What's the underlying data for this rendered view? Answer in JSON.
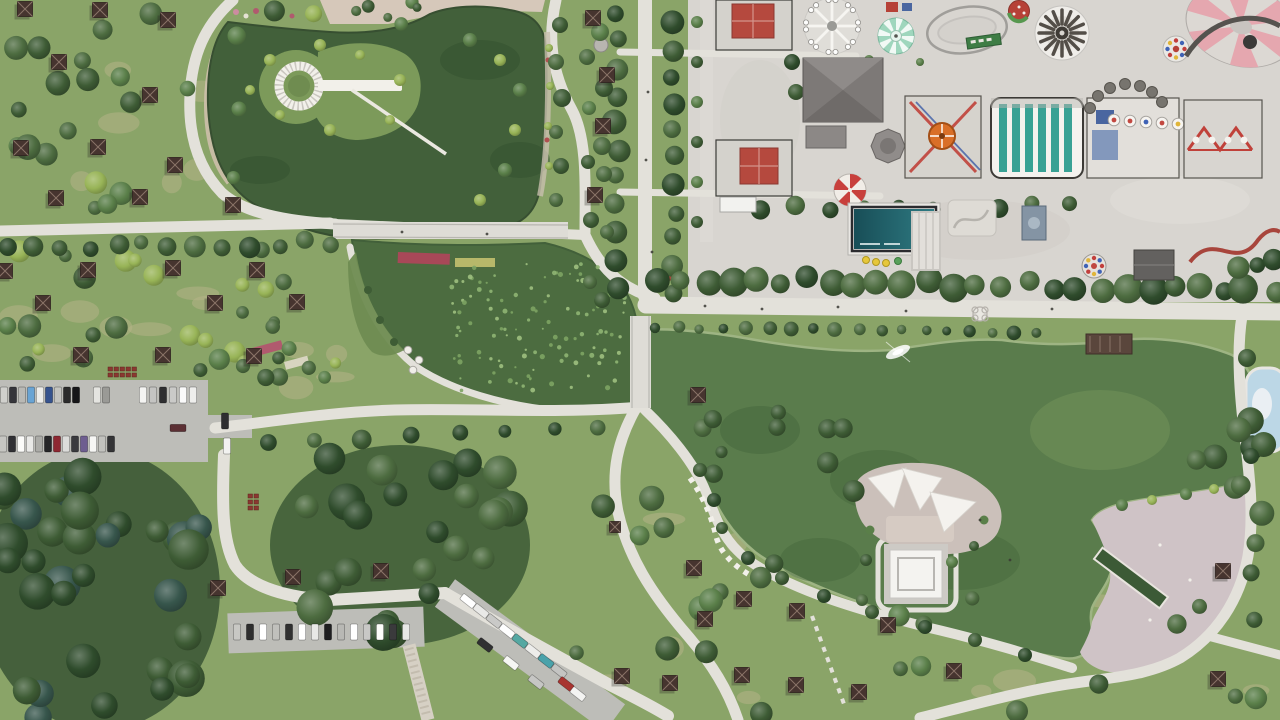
{
  "meta": {
    "description": "Aerial drone photograph of a large urban park: two green ponds connected by channels, winding white paths, picnic gazebo fields, parking lots with cars, dense woods, a pink lakeside plaza with water channel, and an amusement park with rides in the top-right corner",
    "width": 1280,
    "height": 720
  },
  "colors": {
    "grassBase": "#8aa468",
    "grassDry": "#b7b38a",
    "woodsShadow": "#2e4a2e",
    "treePalette": [
      "#4d6c40",
      "#3e5c35",
      "#5a7f49",
      "#2f4c2c",
      "#37564c",
      "#98b457"
    ],
    "lilyPalette": [
      "#8fb573",
      "#9fc07f",
      "#7da463"
    ],
    "path": "#e3e1da",
    "pathDim": "#d7d5ce",
    "asphalt": "#bdbdb8",
    "concrete": "#d8d5d0",
    "pondUpper": "#42603a",
    "pondLily": "#4c6c40",
    "pondMain": "#5a7c4c",
    "poolBlue": "#bcd7e6",
    "plaza": "#cfc3c6",
    "bridge": "#dedcd6",
    "island": "#7c9a5a",
    "islandMain": "#cbc0ba",
    "roofBrown": "#46342f",
    "roofRed": "#b5493e",
    "roofGray": "#7d7977",
    "teal": "#38a194",
    "tealPoolDark": "#184e57",
    "tealPoolLight": "#2f7b83",
    "mint": "#9fd6bd",
    "pinkRide": "#e5a7af",
    "umbrellaRed": "#c8403c",
    "cream": "#f2f0ea",
    "sand": "#cdbfab",
    "pinkPave": "#d6c8ba"
  },
  "scene": {
    "tree_scatter": [
      [
        6,
        4,
        318,
        205,
        24,
        6,
        13,
        11,
        [
          0,
          1,
          2,
          5
        ]
      ],
      [
        4,
        242,
        330,
        130,
        20,
        6,
        12,
        22,
        [
          0,
          1,
          2,
          5
        ]
      ],
      [
        0,
        462,
        210,
        256,
        34,
        11,
        21,
        33,
        [
          3,
          4,
          1
        ]
      ],
      [
        286,
        452,
        240,
        185,
        24,
        10,
        19,
        44,
        [
          3,
          1,
          0
        ]
      ],
      [
        565,
        470,
        290,
        245,
        15,
        7,
        13,
        55,
        [
          0,
          1,
          2
        ]
      ],
      [
        865,
        556,
        410,
        160,
        13,
        7,
        12,
        66,
        [
          0,
          1,
          2
        ]
      ],
      [
        1192,
        420,
        86,
        140,
        10,
        9,
        15,
        77,
        [
          3,
          1,
          0
        ]
      ],
      [
        238,
        345,
        150,
        50,
        6,
        6,
        10,
        88,
        [
          0,
          2,
          1
        ]
      ],
      [
        645,
        412,
        210,
        62,
        8,
        6,
        11,
        99,
        [
          0,
          1,
          2
        ]
      ],
      [
        238,
        248,
        100,
        120,
        8,
        5,
        9,
        111,
        [
          0,
          2,
          5
        ]
      ],
      [
        325,
        2,
        110,
        26,
        6,
        4,
        7,
        122,
        [
          0,
          2,
          1
        ]
      ]
    ],
    "tree_rows": [
      [
        10,
        248,
        330,
        242,
        13,
        9,
        4,
        1
      ],
      [
        617,
        14,
        617,
        286,
        11,
        10,
        3,
        2
      ],
      [
        674,
        22,
        674,
        292,
        11,
        10,
        3,
        3
      ],
      [
        660,
        279,
        1272,
        289,
        26,
        12,
        5,
        4
      ],
      [
        656,
        327,
        1038,
        333,
        18,
        6,
        2,
        5
      ],
      [
        762,
        208,
        1068,
        206,
        10,
        8,
        3,
        6
      ],
      [
        270,
        440,
        600,
        428,
        8,
        8,
        3,
        7
      ],
      [
        1240,
        270,
        1276,
        262,
        3,
        9,
        3,
        9
      ]
    ],
    "tree_singles": [
      [
        560,
        25,
        8,
        1
      ],
      [
        556,
        62,
        8,
        0
      ],
      [
        562,
        98,
        9,
        1
      ],
      [
        556,
        132,
        7,
        0
      ],
      [
        561,
        166,
        8,
        1
      ],
      [
        556,
        200,
        7,
        0
      ],
      [
        600,
        32,
        9,
        2
      ],
      [
        587,
        57,
        8,
        0
      ],
      [
        604,
        88,
        9,
        1
      ],
      [
        589,
        108,
        7,
        2
      ],
      [
        602,
        146,
        9,
        0
      ],
      [
        588,
        162,
        7,
        1
      ],
      [
        604,
        174,
        8,
        0
      ],
      [
        591,
        220,
        8,
        1
      ],
      [
        607,
        232,
        7,
        0
      ],
      [
        270,
        60,
        6,
        5
      ],
      [
        320,
        45,
        6,
        5
      ],
      [
        360,
        55,
        5,
        5
      ],
      [
        400,
        80,
        6,
        5
      ],
      [
        390,
        120,
        5,
        5
      ],
      [
        330,
        130,
        6,
        5
      ],
      [
        280,
        115,
        5,
        5
      ],
      [
        250,
        90,
        5,
        5
      ],
      [
        470,
        40,
        7,
        2
      ],
      [
        500,
        60,
        6,
        5
      ],
      [
        520,
        90,
        7,
        2
      ],
      [
        515,
        130,
        6,
        5
      ],
      [
        505,
        170,
        7,
        2
      ],
      [
        480,
        200,
        6,
        5
      ],
      [
        549,
        48,
        4,
        5
      ],
      [
        550,
        86,
        4,
        5
      ],
      [
        548,
        126,
        4,
        5
      ],
      [
        549,
        166,
        4,
        5
      ],
      [
        1122,
        505,
        6,
        2
      ],
      [
        1152,
        500,
        5,
        5
      ],
      [
        1186,
        494,
        6,
        2
      ],
      [
        1214,
        489,
        5,
        5
      ],
      [
        866,
        560,
        6,
        1
      ],
      [
        952,
        562,
        6,
        2
      ],
      [
        974,
        546,
        5,
        1
      ],
      [
        862,
        600,
        6,
        0
      ],
      [
        1247,
        358,
        9,
        1
      ],
      [
        1251,
        456,
        8,
        3
      ],
      [
        697,
        22,
        6,
        2
      ],
      [
        697,
        62,
        6,
        1
      ],
      [
        697,
        102,
        6,
        2
      ],
      [
        697,
        142,
        6,
        1
      ],
      [
        697,
        182,
        6,
        2
      ],
      [
        697,
        222,
        6,
        1
      ],
      [
        792,
        62,
        8,
        3
      ],
      [
        796,
        92,
        8,
        1
      ],
      [
        869,
        60,
        5,
        2
      ],
      [
        920,
        62,
        4,
        2
      ],
      [
        602,
        300,
        8,
        1
      ],
      [
        590,
        282,
        7,
        0
      ],
      [
        700,
        470,
        7,
        1
      ],
      [
        714,
        500,
        7,
        3
      ],
      [
        722,
        528,
        6,
        1
      ],
      [
        748,
        558,
        7,
        3
      ],
      [
        782,
        578,
        7,
        1
      ],
      [
        824,
        596,
        7,
        3
      ],
      [
        872,
        612,
        7,
        1
      ],
      [
        925,
        627,
        7,
        3
      ],
      [
        975,
        640,
        7,
        1
      ],
      [
        1025,
        655,
        7,
        3
      ]
    ],
    "dry_patches": [
      [
        20,
        30,
        280,
        160,
        8,
        301
      ],
      [
        10,
        260,
        300,
        100,
        8,
        302
      ],
      [
        580,
        480,
        260,
        220,
        6,
        303
      ],
      [
        880,
        570,
        380,
        130,
        5,
        304
      ],
      [
        250,
        350,
        130,
        40,
        3,
        305
      ],
      [
        660,
        420,
        180,
        50,
        3,
        306
      ]
    ],
    "lilies": [
      450,
      264,
      175,
      128,
      120,
      201
    ],
    "gazebos": [
      [
        25,
        9
      ],
      [
        100,
        10
      ],
      [
        168,
        20
      ],
      [
        59,
        62
      ],
      [
        150,
        95
      ],
      [
        21,
        148
      ],
      [
        98,
        147
      ],
      [
        175,
        165
      ],
      [
        56,
        198
      ],
      [
        140,
        197
      ],
      [
        233,
        205
      ],
      [
        5,
        271
      ],
      [
        88,
        270
      ],
      [
        173,
        268
      ],
      [
        257,
        270
      ],
      [
        43,
        303
      ],
      [
        215,
        303
      ],
      [
        297,
        302
      ],
      [
        81,
        355
      ],
      [
        163,
        355
      ],
      [
        254,
        356
      ],
      [
        593,
        18
      ],
      [
        607,
        75
      ],
      [
        603,
        126
      ],
      [
        595,
        195
      ],
      [
        615,
        527,
        11
      ],
      [
        694,
        568
      ],
      [
        744,
        599
      ],
      [
        797,
        611
      ],
      [
        705,
        619
      ],
      [
        622,
        676
      ],
      [
        670,
        683
      ],
      [
        742,
        675
      ],
      [
        796,
        685
      ],
      [
        859,
        692
      ],
      [
        888,
        625
      ],
      [
        954,
        671
      ],
      [
        1218,
        679
      ],
      [
        1223,
        571
      ],
      [
        698,
        395
      ],
      [
        293,
        577
      ],
      [
        381,
        571
      ],
      [
        218,
        588
      ]
    ],
    "cars": [
      [
        4,
        395,
        0,
        "#d0d0cc"
      ],
      [
        13,
        395,
        0,
        "#35353a"
      ],
      [
        22,
        395,
        0,
        "#b9b9b5"
      ],
      [
        31,
        395,
        0,
        "#69a4d4"
      ],
      [
        40,
        395,
        0,
        "#ececea"
      ],
      [
        49,
        395,
        0,
        "#36538e"
      ],
      [
        58,
        395,
        0,
        "#c4c4c0"
      ],
      [
        67,
        395,
        0,
        "#2b2b2b"
      ],
      [
        76,
        395,
        0,
        "#161618"
      ],
      [
        97,
        395,
        0,
        "#e4e4e0"
      ],
      [
        106,
        395,
        0,
        "#9a9a96"
      ],
      [
        143,
        395,
        0,
        "#f4f4f2"
      ],
      [
        153,
        395,
        0,
        "#c4c4c2"
      ],
      [
        163,
        395,
        0,
        "#2e2e30"
      ],
      [
        173,
        395,
        0,
        "#cacac8"
      ],
      [
        183,
        395,
        0,
        "#fafafa"
      ],
      [
        193,
        395,
        0,
        "#eeeeec"
      ],
      [
        3,
        444,
        0,
        "#c6c6c2"
      ],
      [
        12,
        444,
        0,
        "#303034"
      ],
      [
        21,
        444,
        0,
        "#fbfbf9"
      ],
      [
        30,
        444,
        0,
        "#e9e9e7"
      ],
      [
        39,
        444,
        0,
        "#ababa7"
      ],
      [
        48,
        444,
        0,
        "#262628"
      ],
      [
        57,
        444,
        0,
        "#8e2832"
      ],
      [
        66,
        444,
        0,
        "#dcdcda"
      ],
      [
        75,
        444,
        0,
        "#3a3a3e"
      ],
      [
        84,
        444,
        0,
        "#6e5e90"
      ],
      [
        93,
        444,
        0,
        "#f6f6f4"
      ],
      [
        102,
        444,
        0,
        "#c2c2be"
      ],
      [
        111,
        444,
        0,
        "#343436"
      ],
      [
        178,
        428,
        90,
        "#5c3034"
      ],
      [
        225,
        421,
        0,
        "#2e2e30"
      ],
      [
        227,
        446,
        0,
        "#f2f2f0"
      ],
      [
        237,
        632,
        0,
        "#c8c8c4"
      ],
      [
        250,
        632,
        0,
        "#2e2e2e"
      ],
      [
        263,
        632,
        0,
        "#ffffff"
      ],
      [
        276,
        632,
        0,
        "#c0c0bc"
      ],
      [
        289,
        632,
        0,
        "#303030"
      ],
      [
        302,
        632,
        0,
        "#ffffff"
      ],
      [
        315,
        632,
        0,
        "#e8e8e6"
      ],
      [
        328,
        632,
        0,
        "#1e1e20"
      ],
      [
        341,
        632,
        0,
        "#b8b8b4"
      ],
      [
        354,
        632,
        0,
        "#ffffff"
      ],
      [
        367,
        632,
        0,
        "#c8c8c6"
      ],
      [
        380,
        632,
        0,
        "#fdfdfb"
      ],
      [
        393,
        632,
        0,
        "#3a3a3c"
      ],
      [
        406,
        632,
        0,
        "#e8e8e6"
      ],
      [
        468,
        601,
        -52,
        "#ffffff"
      ],
      [
        481,
        611,
        -52,
        "#e9e9e7"
      ],
      [
        494,
        621,
        -52,
        "#c9c9c7"
      ],
      [
        507,
        631,
        -52,
        "#ffffff"
      ],
      [
        520,
        641,
        -52,
        "#55a8a2"
      ],
      [
        533,
        651,
        -52,
        "#ededeb"
      ],
      [
        546,
        661,
        -52,
        "#4aa2aa"
      ],
      [
        559,
        671,
        -52,
        "#c4c4c2"
      ],
      [
        566,
        684,
        -52,
        "#a83430"
      ],
      [
        578,
        694,
        -52,
        "#f4f4f2"
      ],
      [
        485,
        645,
        -52,
        "#303032"
      ],
      [
        511,
        663,
        -52,
        "#f6f6f4"
      ],
      [
        536,
        682,
        -52,
        "#c6c6c4"
      ]
    ],
    "picnic_tables": [
      [
        108,
        367,
        5,
        2
      ],
      [
        248,
        494,
        2,
        3
      ]
    ],
    "people": [
      [
        705,
        306
      ],
      [
        762,
        309
      ],
      [
        838,
        307
      ],
      [
        906,
        311
      ],
      [
        1052,
        309
      ],
      [
        646,
        160
      ],
      [
        648,
        92
      ],
      [
        402,
        232
      ],
      [
        487,
        234
      ],
      [
        652,
        252
      ],
      [
        980,
        520
      ],
      [
        1010,
        560
      ]
    ]
  }
}
